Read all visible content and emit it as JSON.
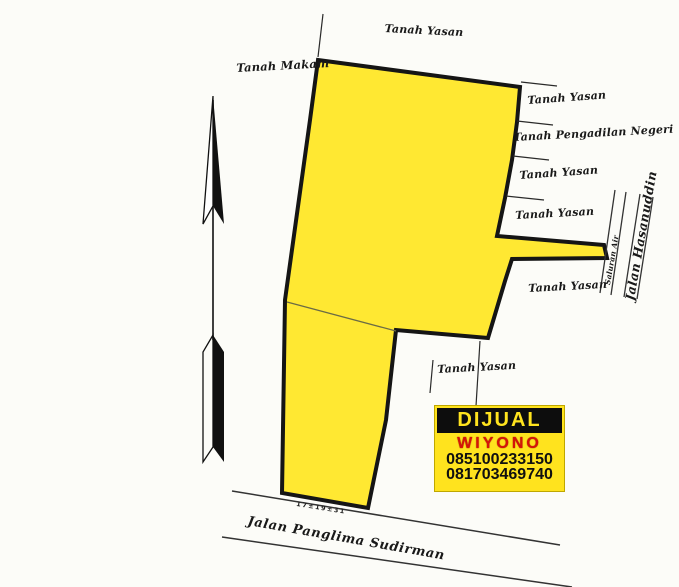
{
  "map": {
    "parcels": {
      "north": "Tanah Yasan",
      "west": "Tanah Makam",
      "east_1": "Tanah Yasan",
      "east_2": "Tanah Pengadilan Negeri",
      "east_3": "Tanah Yasan",
      "east_4": "Tanah Yasan",
      "east_5": "Tanah Yasan",
      "south_east": "Tanah Yasan"
    },
    "roads": {
      "south_road": "Jalan Panglima Sudirman",
      "east_road": "Jalan Hasanuddin",
      "east_channel": "Saluran Air"
    },
    "annotations": {
      "frontage_marks": "17±19±31"
    }
  },
  "sign": {
    "title": "DIJUAL",
    "owner": "WIYONO",
    "phone_1": "085100233150",
    "phone_2": "081703469740"
  },
  "colors": {
    "land_fill": "#ffe832",
    "land_outline": "#151515",
    "sign_bg": "#ffe31e",
    "sign_banner_bg": "#0d0d0d",
    "sign_title_color": "#ffe31e",
    "sign_owner_color": "#d61408",
    "sign_phone_color": "#101010"
  }
}
